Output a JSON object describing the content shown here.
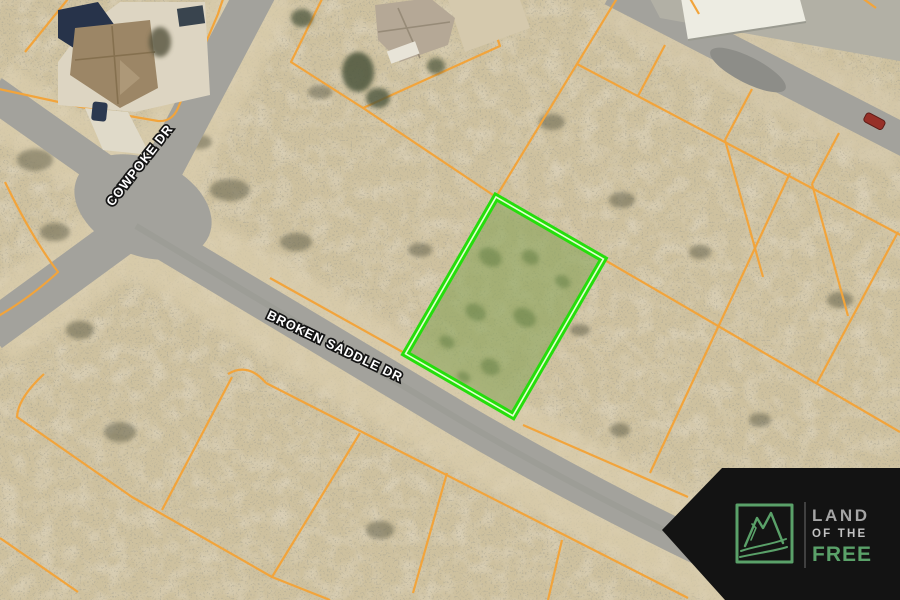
{
  "map": {
    "type": "satellite-aerial",
    "street_labels": [
      {
        "text": "COWPOKE DR"
      },
      {
        "text": "BROKEN SADDLE DR"
      }
    ],
    "highlighted_parcel": {
      "description": "vacant lot outlined for sale",
      "border_color": "#25de0c",
      "inner_line_color": "#e6ffd2",
      "fill_tint": "#8aa45c"
    },
    "parcel_line_color": "#f2a43b",
    "road_color": "#a3a29c",
    "terrain_color": "#cec19f"
  },
  "branding": {
    "banner_color": "#131313",
    "logo_icon": "mountain-river-icon",
    "accent_green": "#5aa169",
    "line1": "LAND",
    "line2": "OF THE",
    "line3": "FREE"
  }
}
